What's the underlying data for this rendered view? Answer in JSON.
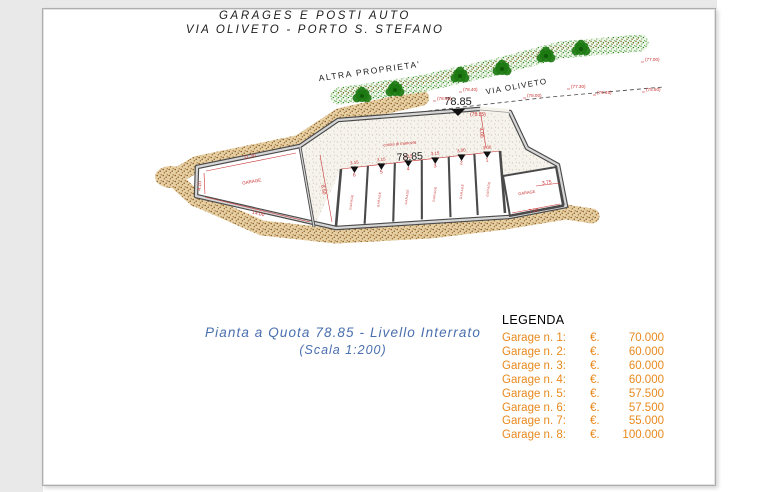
{
  "title": {
    "line1": "GARAGES E POSTI AUTO",
    "line2": "VIA OLIVETO - PORTO S. STEFANO"
  },
  "plan": {
    "area_labels": {
      "altra_proprieta": "ALTRA PROPRIETA'",
      "via_oliveto": "VIA OLIVETO"
    },
    "levels": {
      "entry": "78.85",
      "entry_paren": "(78.85)",
      "driveway": "78.85"
    },
    "driveway_note": "corsia di manovra",
    "room_labels": {
      "big_room": "GARAGE",
      "room7": "GARAGE"
    },
    "dims": {
      "big_top": "11.30",
      "big_left": "4.10",
      "big_bottom": "14.00",
      "strip": "8.50",
      "entry": "4.00",
      "room7_w": "3.75",
      "room7_b": "7.90"
    },
    "stalls": [
      {
        "num": "6",
        "dim": "3.15"
      },
      {
        "num": "5",
        "dim": "3.15"
      },
      {
        "num": "4",
        "dim": "3.15"
      },
      {
        "num": "3",
        "dim": "3.15"
      },
      {
        "num": "2",
        "dim": "3.00"
      },
      {
        "num": "1",
        "dim": "3.00"
      }
    ],
    "road_levels": [
      "(78.45)",
      "(78.40)",
      "(78.00)",
      "(77.30)",
      "(77.00)",
      "(75.50)",
      "(76.45)"
    ]
  },
  "caption": {
    "line1": "Pianta a Quota 78.85 - Livello Interrato",
    "line2": "(Scala 1:200)"
  },
  "legend": {
    "title": "LEGENDA",
    "rows": [
      {
        "name": "Garage n. 1:",
        "cur": "€.",
        "price": "70.000"
      },
      {
        "name": "Garage n. 2:",
        "cur": "€.",
        "price": "60.000"
      },
      {
        "name": "Garage n. 3:",
        "cur": "€.",
        "price": "60.000"
      },
      {
        "name": "Garage n. 4:",
        "cur": "€.",
        "price": "60.000"
      },
      {
        "name": "Garage n. 5:",
        "cur": "€.",
        "price": "57.500"
      },
      {
        "name": "Garage n. 6:",
        "cur": "€.",
        "price": "57.500"
      },
      {
        "name": "Garage n. 7:",
        "cur": "€.",
        "price": "55.000"
      },
      {
        "name": "Garage n. 8:",
        "cur": "€.",
        "price": "100.000"
      }
    ]
  },
  "colors": {
    "legend_orange": "#E8891D",
    "caption_blue": "#4A6FAE",
    "dim_red": "#C83232",
    "earth_brown": "#A87A3C",
    "hedge_green": "#2E8B22",
    "wall_gray": "#4A4A4A"
  }
}
